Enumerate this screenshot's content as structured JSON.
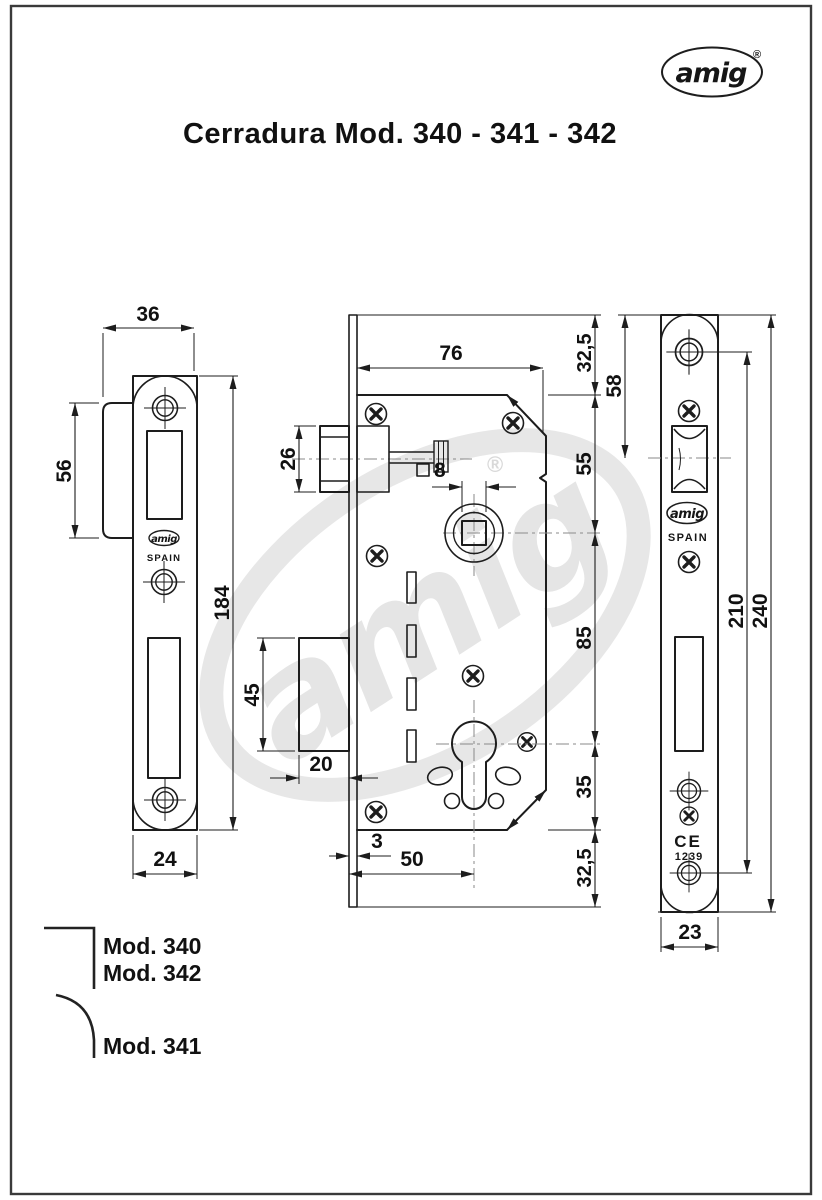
{
  "page": {
    "title": "Cerradura Mod. 340 - 341 - 342"
  },
  "brand": {
    "logo_text": "amig",
    "registered_mark": "®",
    "watermark_text": "amig"
  },
  "strike_plate_view": {
    "dim_total_depth": "36",
    "dim_lip_height": "56",
    "dim_plate_height": "184",
    "dim_plate_width": "24",
    "brand_text": "amig",
    "origin_text": "SPAIN"
  },
  "lock_body_view": {
    "dim_body_width": "76",
    "dim_top_margin": "32,5",
    "dim_latch_height": "26",
    "dim_spindle_square": "8",
    "dim_plate_to_spindle": "55",
    "dim_spindle_to_cylinder": "85",
    "dim_deadbolt_height": "45",
    "dim_deadbolt_throw": "20",
    "dim_cylinder_to_body_bottom": "35",
    "dim_faceplate_thickness": "3",
    "dim_backset": "50",
    "dim_bottom_margin": "32,5"
  },
  "faceplate_view": {
    "dim_top_to_latch_center": "58",
    "dim_screw_centers": "210",
    "dim_plate_height": "240",
    "dim_plate_width": "23",
    "brand_text": "amig",
    "origin_text": "SPAIN",
    "ce_mark": "CE",
    "ce_number": "1239"
  },
  "legend": {
    "square_corner_models": [
      "Mod. 340",
      "Mod. 342"
    ],
    "round_corner_models": [
      "Mod. 341"
    ]
  }
}
